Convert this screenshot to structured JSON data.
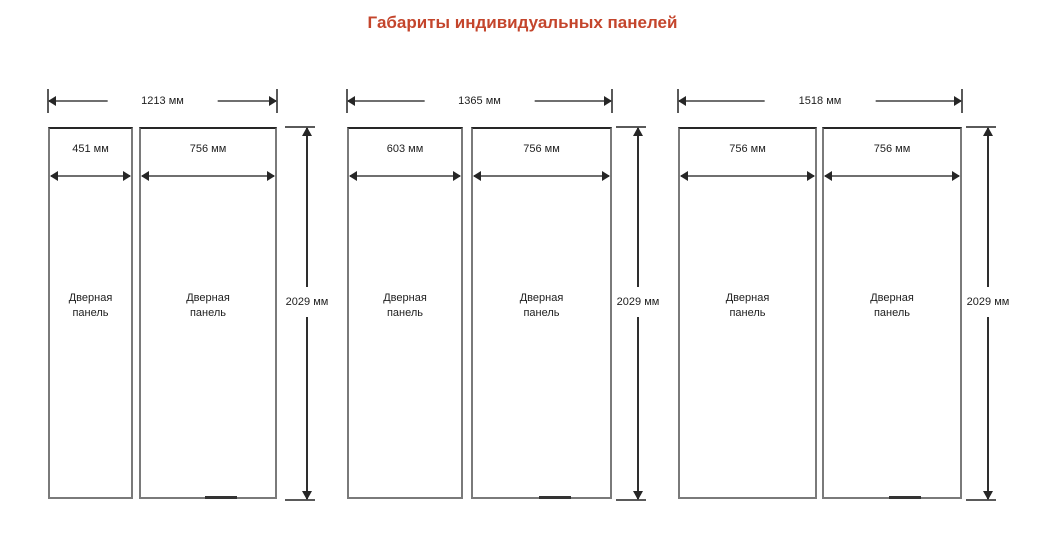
{
  "title": "Габариты индивидуальных панелей",
  "colors": {
    "title": "#c4452c",
    "dimension_line": "#6f6f6f",
    "text": "#1e1e1e"
  },
  "unit": "мм",
  "groups": [
    {
      "total_width": "1213 мм",
      "height": "2029 мм",
      "panels": [
        {
          "width": "451 мм",
          "name": "Дверная панель"
        },
        {
          "width": "756 мм",
          "name": "Дверная панель"
        }
      ]
    },
    {
      "total_width": "1365 мм",
      "height": "2029 мм",
      "panels": [
        {
          "width": "603 мм",
          "name": "Дверная панель"
        },
        {
          "width": "756 мм",
          "name": "Дверная панель"
        }
      ]
    },
    {
      "total_width": "1518 мм",
      "height": "2029 мм",
      "panels": [
        {
          "width": "756 мм",
          "name": "Дверная панель"
        },
        {
          "width": "756 мм",
          "name": "Дверная панель"
        }
      ]
    }
  ]
}
